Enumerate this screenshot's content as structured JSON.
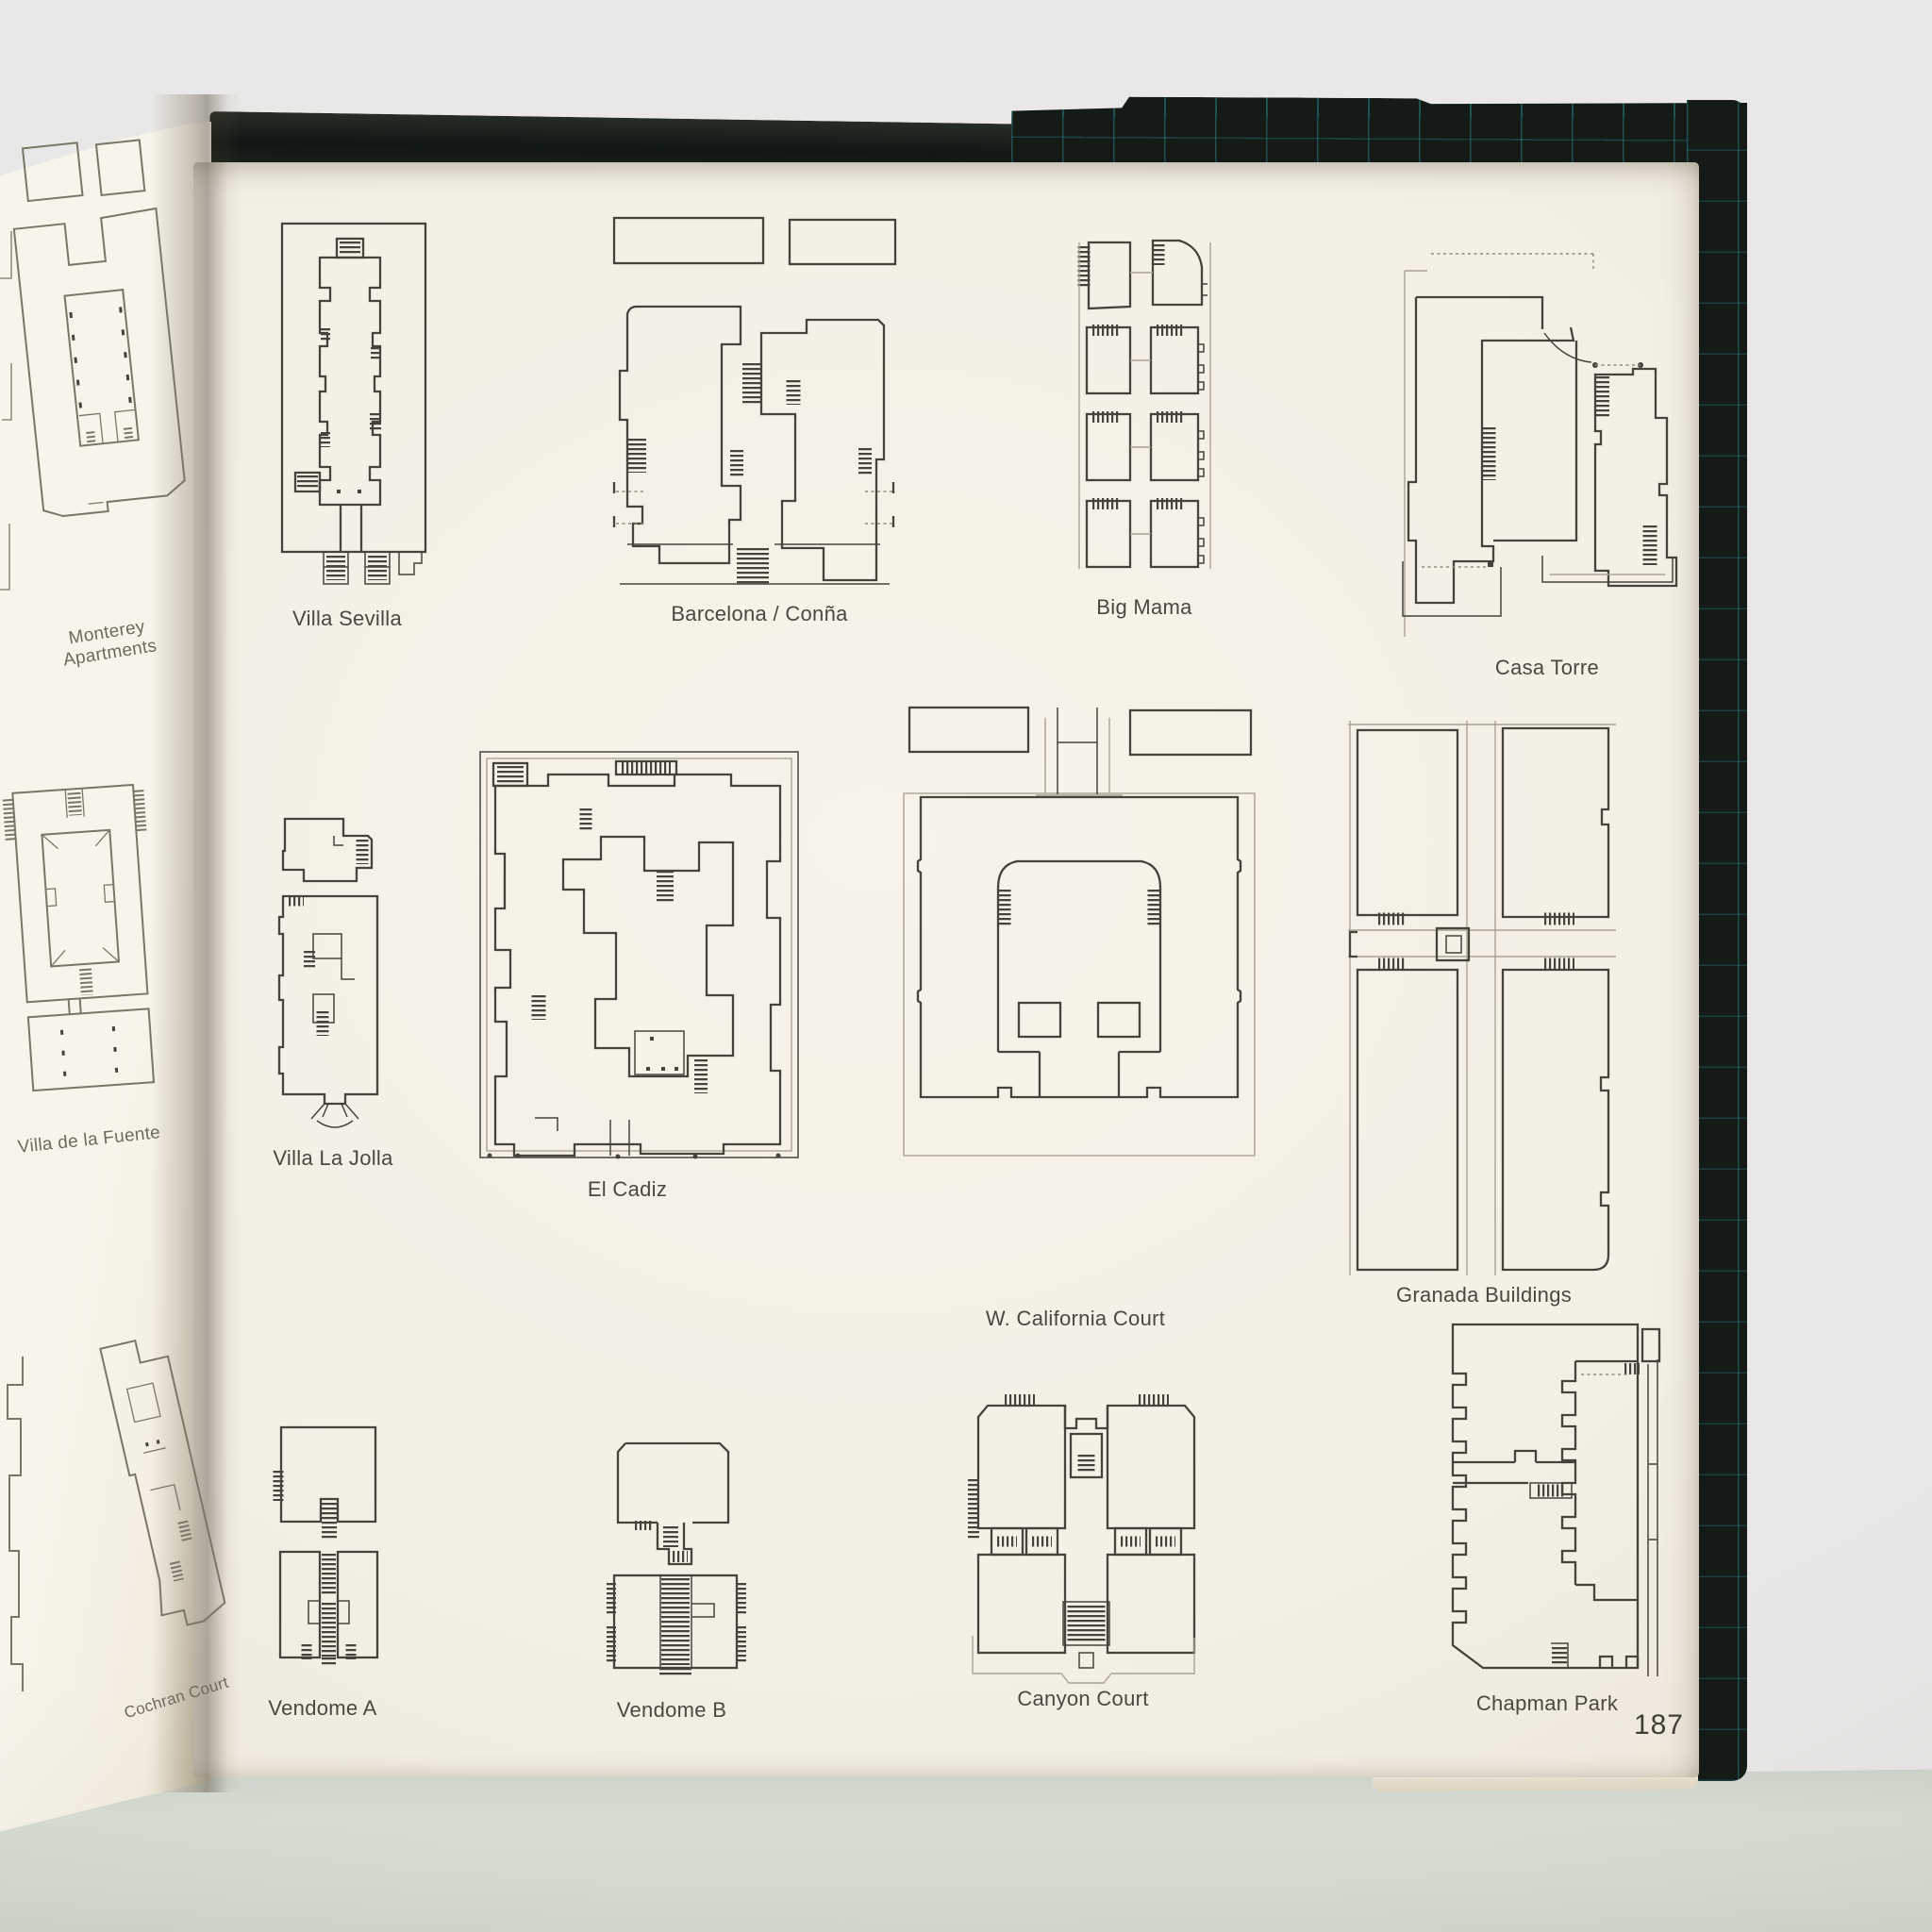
{
  "book": {
    "page_number": "187",
    "colors": {
      "cover": "#141b17",
      "cover_grid": "#2a7c82",
      "paper": "#f3efe5",
      "surface": "#e9e8e6",
      "table": "#d5dad1",
      "ink": "#45443c"
    }
  },
  "left_page": {
    "figures": [
      {
        "id": "monterey-apartments",
        "label": "Monterey Apartments"
      },
      {
        "id": "villa-de-la-fuente",
        "label": "Villa de la Fuente"
      },
      {
        "id": "cochran-court",
        "label": "Cochran Court"
      }
    ]
  },
  "right_page": {
    "figures": [
      {
        "id": "villa-sevilla",
        "label": "Villa Sevilla"
      },
      {
        "id": "barcelona-conna",
        "label": "Barcelona / Conña"
      },
      {
        "id": "big-mama",
        "label": "Big Mama"
      },
      {
        "id": "casa-torre",
        "label": "Casa Torre"
      },
      {
        "id": "villa-la-jolla",
        "label": "Villa La Jolla"
      },
      {
        "id": "el-cadiz",
        "label": "El Cadiz"
      },
      {
        "id": "w-california-court",
        "label": "W. California Court"
      },
      {
        "id": "granada-buildings",
        "label": "Granada Buildings"
      },
      {
        "id": "vendome-a",
        "label": "Vendome A"
      },
      {
        "id": "vendome-b",
        "label": "Vendome B"
      },
      {
        "id": "canyon-court",
        "label": "Canyon Court"
      },
      {
        "id": "chapman-park",
        "label": "Chapman Park"
      }
    ],
    "page_number": "187"
  }
}
